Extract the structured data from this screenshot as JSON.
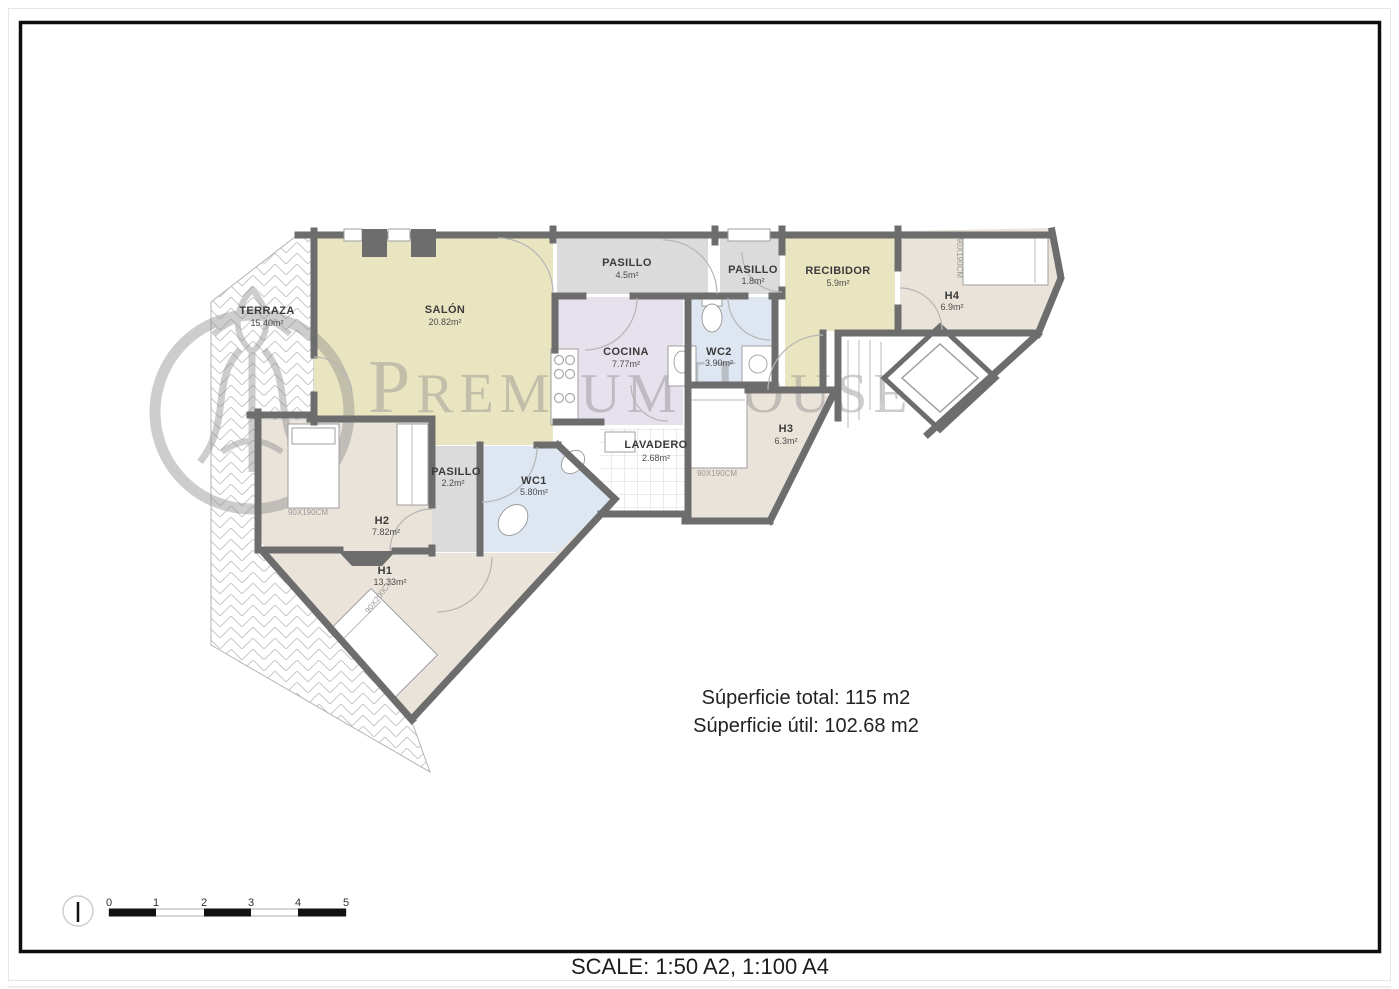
{
  "page": {
    "footer_scale_text": "SCALE: 1:50 A2, 1:100 A4",
    "summary_line1": "Súperficie total: 115 m2",
    "summary_line2": "Súperficie útil: 102.68 m2"
  },
  "watermark": {
    "p1_initial": "P",
    "p1_rest": "REMIUM",
    "p2_initial": "H",
    "p2_rest": "OUSES"
  },
  "rooms": [
    {
      "name": "TERRAZA",
      "area": "15.40m²"
    },
    {
      "name": "SALÓN",
      "area": "20.82m²"
    },
    {
      "name": "PASILLO",
      "area": "4.5m²"
    },
    {
      "name": "PASILLO",
      "area": "1.8m²"
    },
    {
      "name": "RECIBIDOR",
      "area": "5.9m²"
    },
    {
      "name": "H4",
      "area": "6.9m²"
    },
    {
      "name": "COCINA",
      "area": "7.77m²"
    },
    {
      "name": "WC2",
      "area": "3.90m²"
    },
    {
      "name": "LAVADERO",
      "area": "2.68m²"
    },
    {
      "name": "H3",
      "area": "6.3m²"
    },
    {
      "name": "PASILLO",
      "area": "2.2m²"
    },
    {
      "name": "WC1",
      "area": "5.80m²"
    },
    {
      "name": "H2",
      "area": "7.82m²"
    },
    {
      "name": "H1",
      "area": "13.33m²"
    }
  ],
  "beds": {
    "h4_label": "90X190CM",
    "h3_label": "90X190CM",
    "h2_label": "90X190CM",
    "h1_label": "90X200CM"
  },
  "scale_bar": {
    "ticks": [
      "0",
      "1",
      "2",
      "3",
      "4",
      "5"
    ]
  },
  "colors": {
    "wall": "#6d6d6d",
    "salon_yellow": "#eae5c1",
    "bedroom_beige": "#e9e3da",
    "hallway_gray": "#dbdbdb",
    "kitchen_lavender": "#e7e0ed",
    "bath_blue": "#dee6f2",
    "watermark_gray": "#8a8a8a"
  }
}
